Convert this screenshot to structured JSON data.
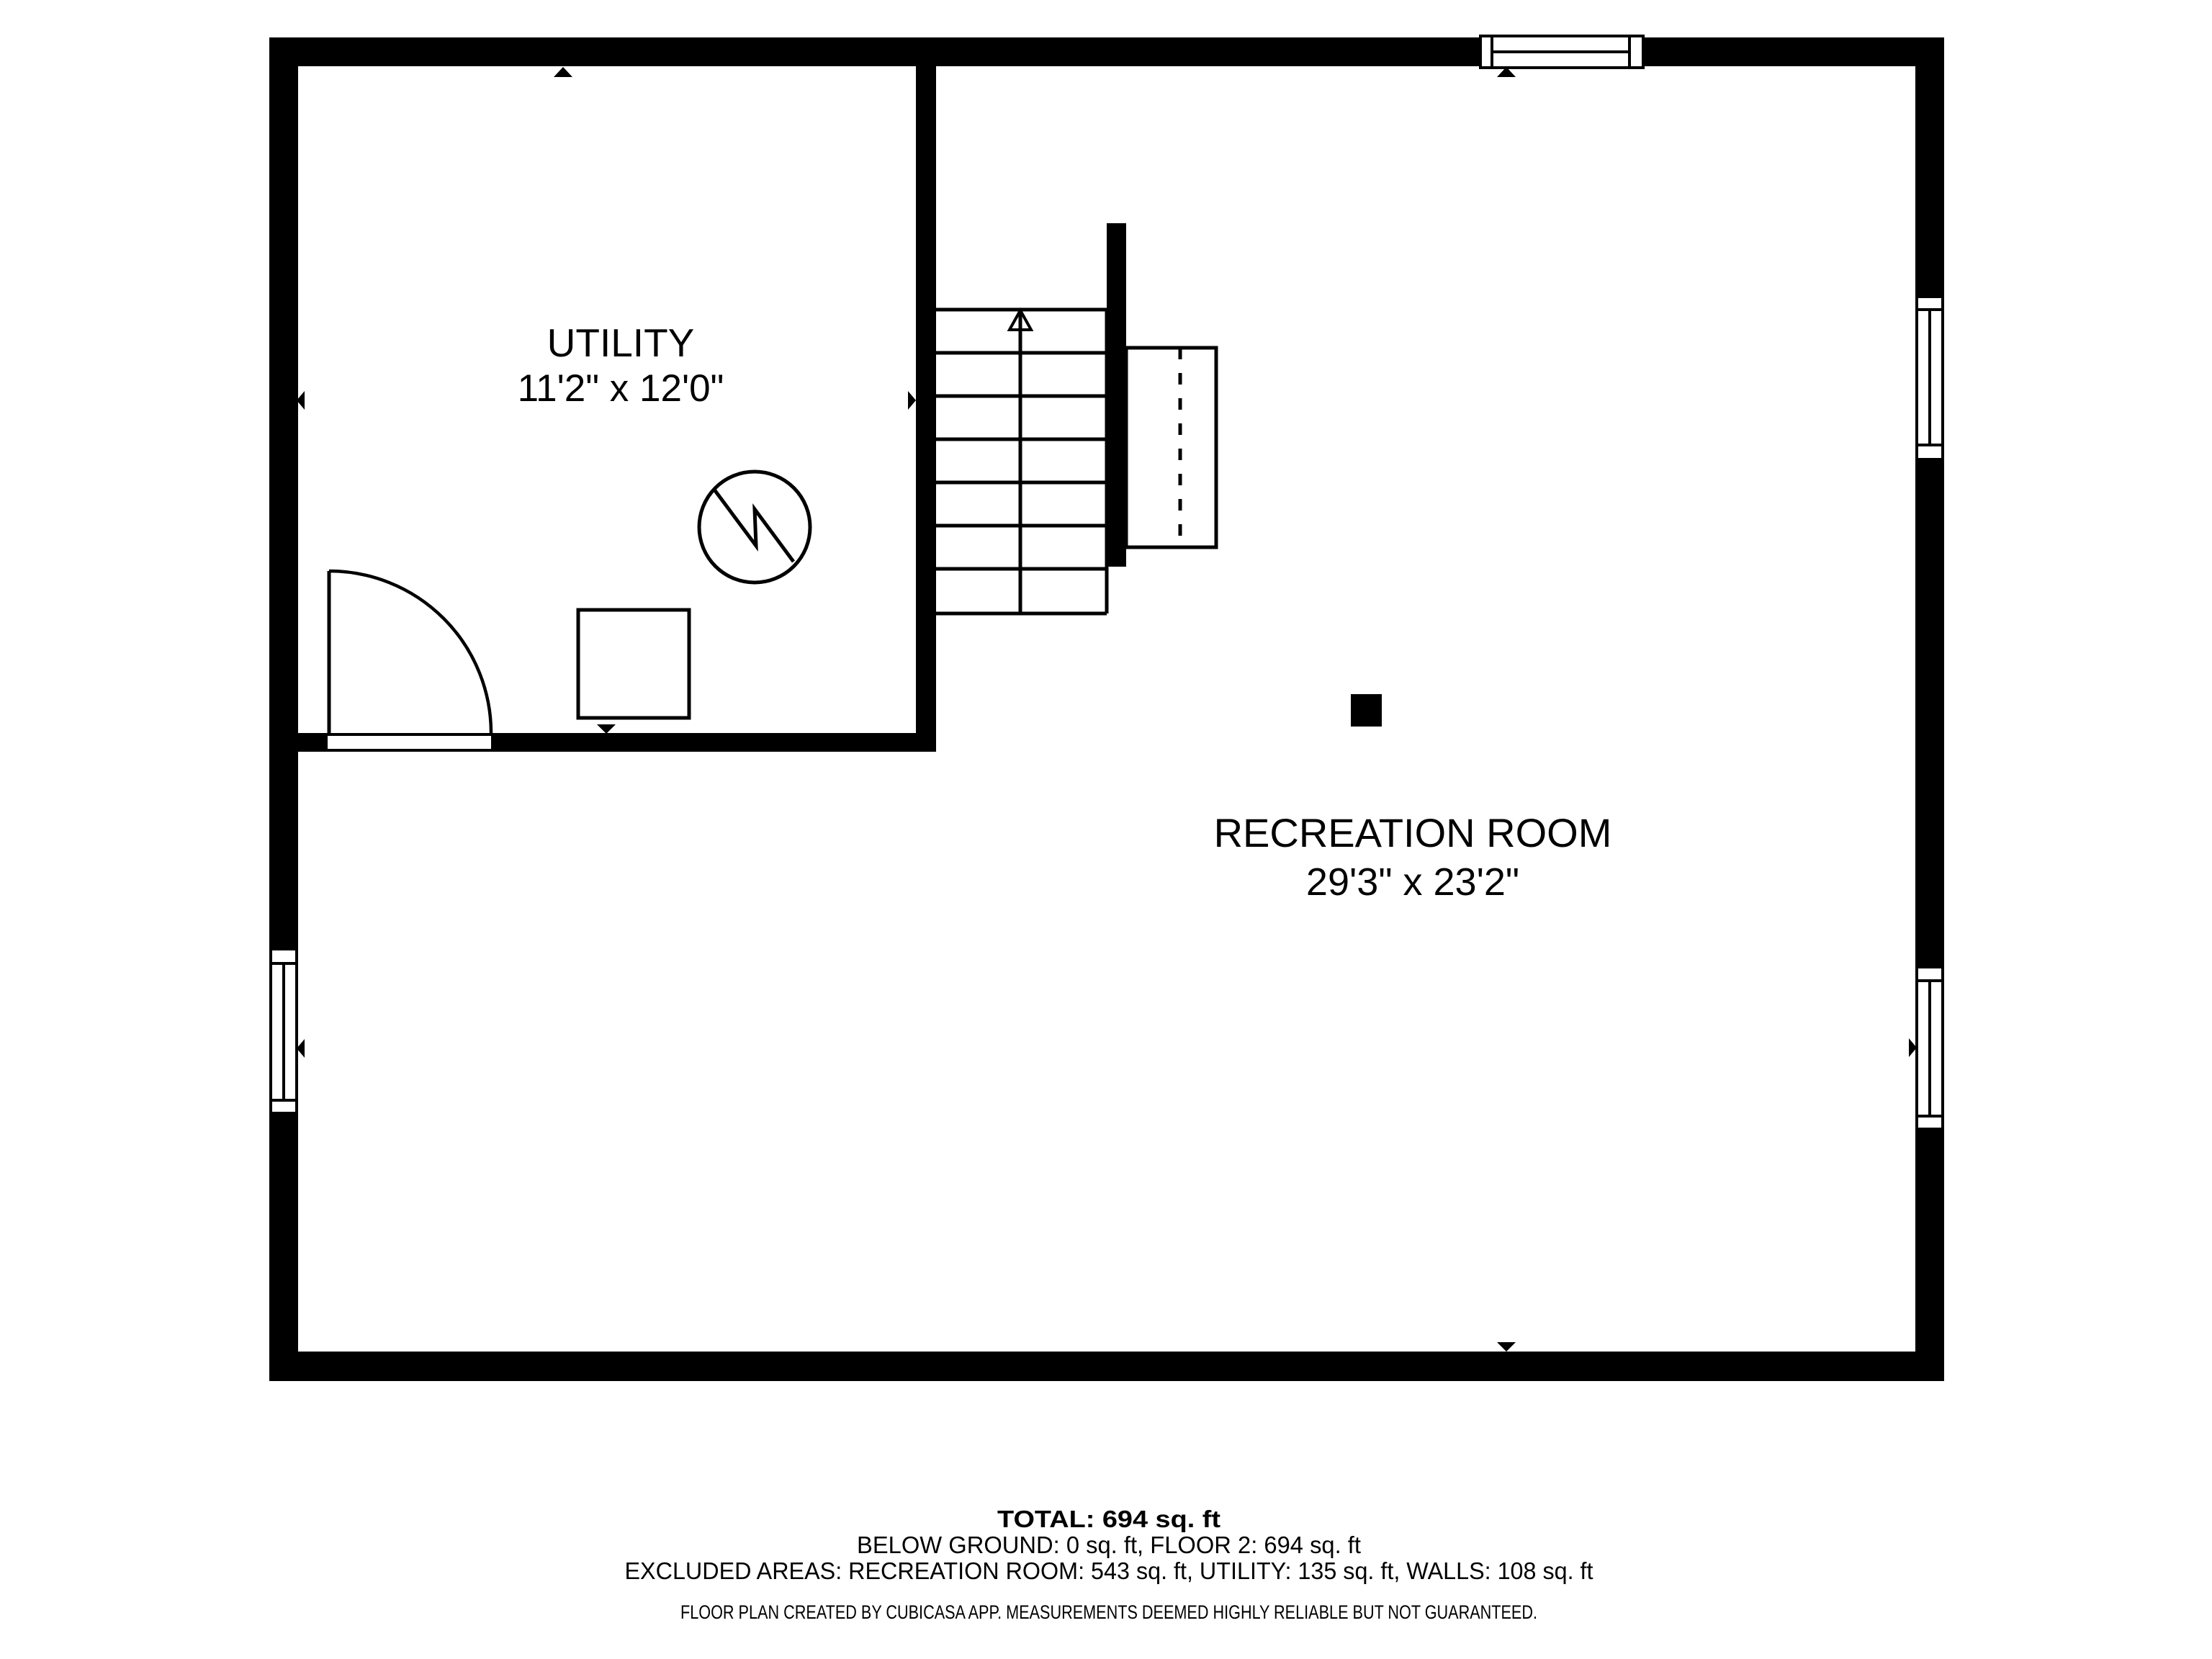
{
  "plan": {
    "rooms": {
      "utility": {
        "name": "UTILITY",
        "dimensions": "11'2\" x 12'0\""
      },
      "recreation": {
        "name": "RECREATION ROOM",
        "dimensions": "29'3\" x 23'2\""
      }
    },
    "features": {
      "staircase": "stairs-up-arrow",
      "door": "door-swing-arc",
      "water_heater": "water-heater-icon",
      "furnace": "furnace-square-icon",
      "chimney": "chimney-block",
      "windows": "window-symbol",
      "wall_markers": "wall-direction-arrow",
      "overhang": "dashed-overhang-outline"
    },
    "colors": {
      "wall": "#000000",
      "background": "#ffffff"
    }
  },
  "summary": {
    "total": "TOTAL: 694 sq. ft",
    "floors": "BELOW GROUND: 0 sq. ft, FLOOR 2: 694 sq. ft",
    "excluded": "EXCLUDED AREAS: RECREATION ROOM: 543 sq. ft, UTILITY: 135 sq. ft, WALLS: 108 sq. ft",
    "disclaimer": "FLOOR PLAN CREATED BY CUBICASA APP. MEASUREMENTS DEEMED HIGHLY RELIABLE BUT NOT GUARANTEED."
  }
}
